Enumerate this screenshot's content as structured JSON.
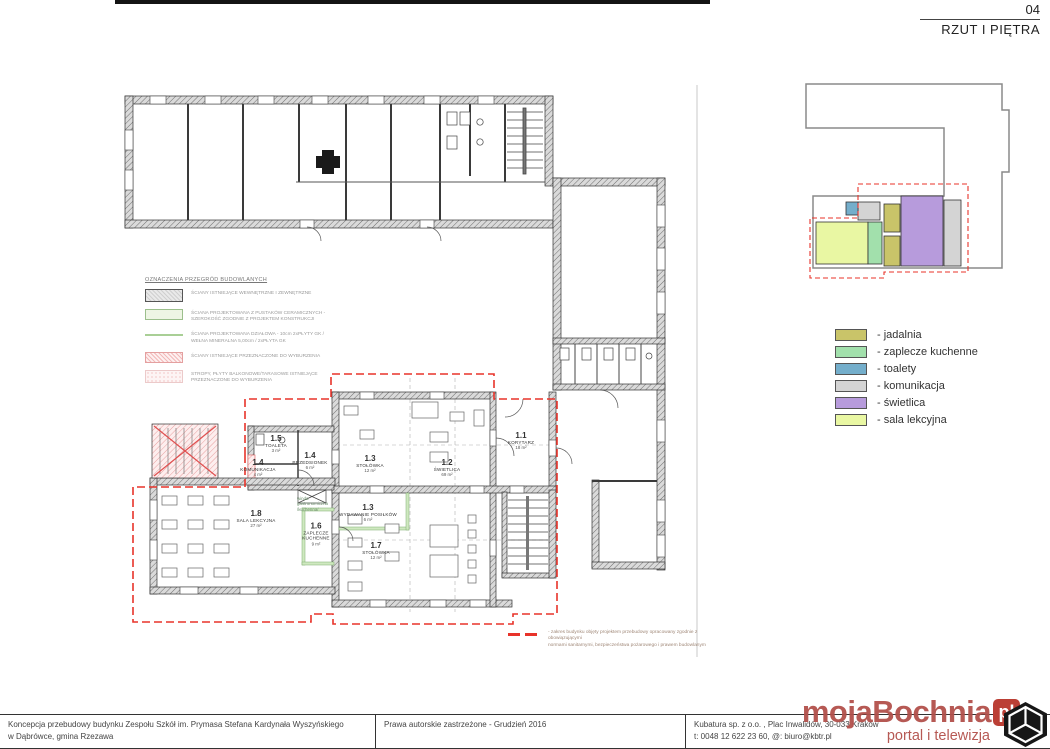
{
  "sheet": {
    "number": "04",
    "title": "RZUT I PIĘTRA"
  },
  "plan": {
    "rooms": [
      {
        "number": "1.1",
        "name": "KORYTARZ",
        "area": "18 m²"
      },
      {
        "number": "1.2",
        "name": "ŚWIETLICA",
        "area": "69 m²"
      },
      {
        "number": "1.3",
        "name": "STOŁÓWKA",
        "area": "12 m²"
      },
      {
        "number": "1.3",
        "name": "WYDAWANIE POSIŁKÓW",
        "area": "6 m²"
      },
      {
        "number": "1.4",
        "name": "PRZEDSIONEK",
        "area": "6 m²"
      },
      {
        "number": "1.4",
        "name": "KOMUNIKACJA",
        "area": "4 m²"
      },
      {
        "number": "1.5",
        "name": "TOALETA",
        "area": "3 m²"
      },
      {
        "number": "1.6",
        "name": "ZAPLECZE KUCHENNE",
        "area": "9 m²"
      },
      {
        "number": "1.7",
        "name": "STOŁÓWKA",
        "area": "12 m²"
      },
      {
        "number": "1.8",
        "name": "SALA LEKCYJNA",
        "area": "27 m²"
      }
    ],
    "lift_note": "winda\ngastronomiczna\n/kuchenna/",
    "scope_note": "- zakres budynku objęty projektem przebudowy opracowany zgodnie z obowiązującymi\nnormami sanitarnymi, bezpieczeństwa pożarowego i prawem budowlanym"
  },
  "wall_legend": {
    "title": "OZNACZENIA PRZEGRÓD BUDOWLANYCH",
    "items": [
      {
        "label": "ŚCIANY ISTNIEJĄCE WEWNĘTRZNE I ZEWNĘTRZNE"
      },
      {
        "label": "ŚCIANA PROJEKTOWANA Z PUSTAKÓW CERAMICZNYCH - SZEROKOŚĆ ZGODNIE Z PROJEKTEM KONSTRUKCJI"
      },
      {
        "label": "ŚCIANA PROJEKTOWANA DZIAŁOWA - 10cm 2xPŁYTY GK / WEŁNA MINERALNA 5,00cm / 2xPŁYTA GK"
      },
      {
        "label": "ŚCIANY ISTNIEJĄCE PRZEZNACZONE DO WYBURZENIA"
      },
      {
        "label": "STROPY, PŁYTY BALKONOWE/TARASOWE ISTNIEJĄCE PRZEZNACZONE DO WYBURZENIA"
      }
    ]
  },
  "color_legend": {
    "items": [
      {
        "label": "- jadalnia",
        "color": "#c9c469"
      },
      {
        "label": "- zaplecze kuchenne",
        "color": "#a2e0ac"
      },
      {
        "label": "- toalety",
        "color": "#74aecb"
      },
      {
        "label": "- komunikacja",
        "color": "#d4d4d4"
      },
      {
        "label": "- świetlica",
        "color": "#b79bdc"
      },
      {
        "label": "- sala lekcyjna",
        "color": "#e9f7a3"
      }
    ]
  },
  "footer": {
    "project_title": "Koncepcja przebudowy budynku Zespołu Szkół  im. Prymasa Stefana Kardynała Wyszyńskiego\nw Dąbrówce, gmina Rzezawa",
    "copyright": "Prawa autorskie zastrzeżone - Grudzień 2016",
    "company": "Kubatura sp. z o.o. ,  Plac Inwalidów, 30-033 Kraków\nt: 0048 12 622 23 60,  @: biuro@kbtr.pl"
  },
  "watermark": {
    "brand": "mojaBochnia",
    "tld": "pl",
    "tagline": "portal i telewizja"
  }
}
